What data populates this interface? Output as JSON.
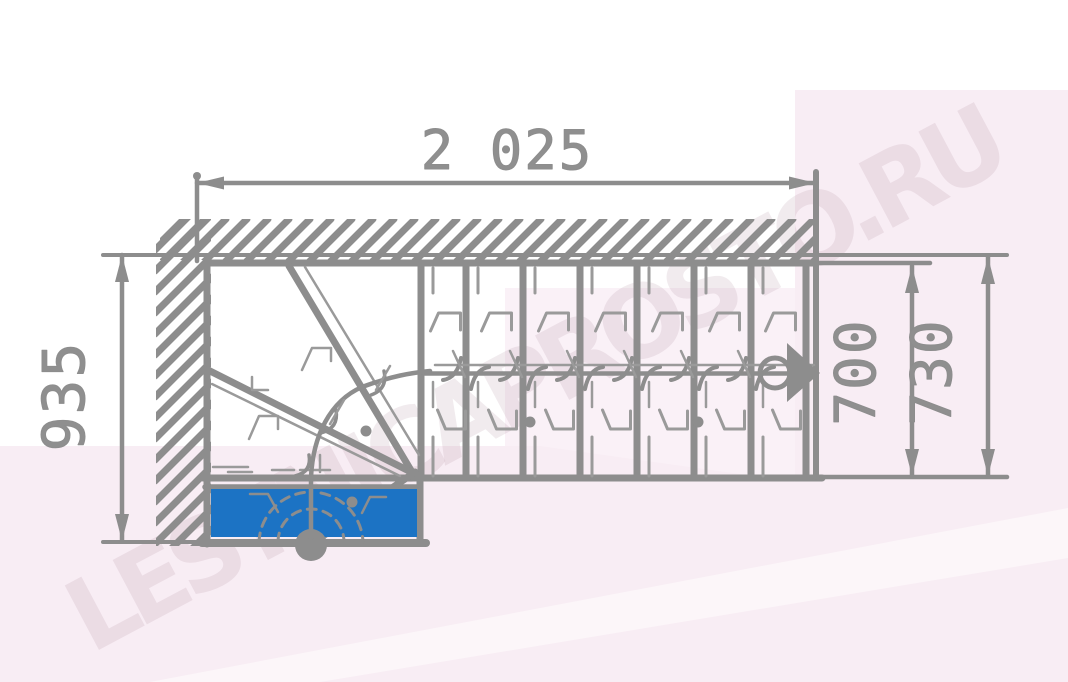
{
  "watermark": {
    "text": "LESTNICAPROSTO.RU"
  },
  "dimensions": {
    "total_run": "2 025",
    "side_depth": "935",
    "flight_width": "700",
    "overall_width": "730"
  },
  "colors": {
    "line": "#8d8d8d",
    "line_thin": "#9a9a9a",
    "first_step_highlight": "#1c73c4",
    "background_tint": "#f8edf4",
    "background_tint_light": "#faf1f7",
    "dimension_text": "#8f8f8f"
  }
}
